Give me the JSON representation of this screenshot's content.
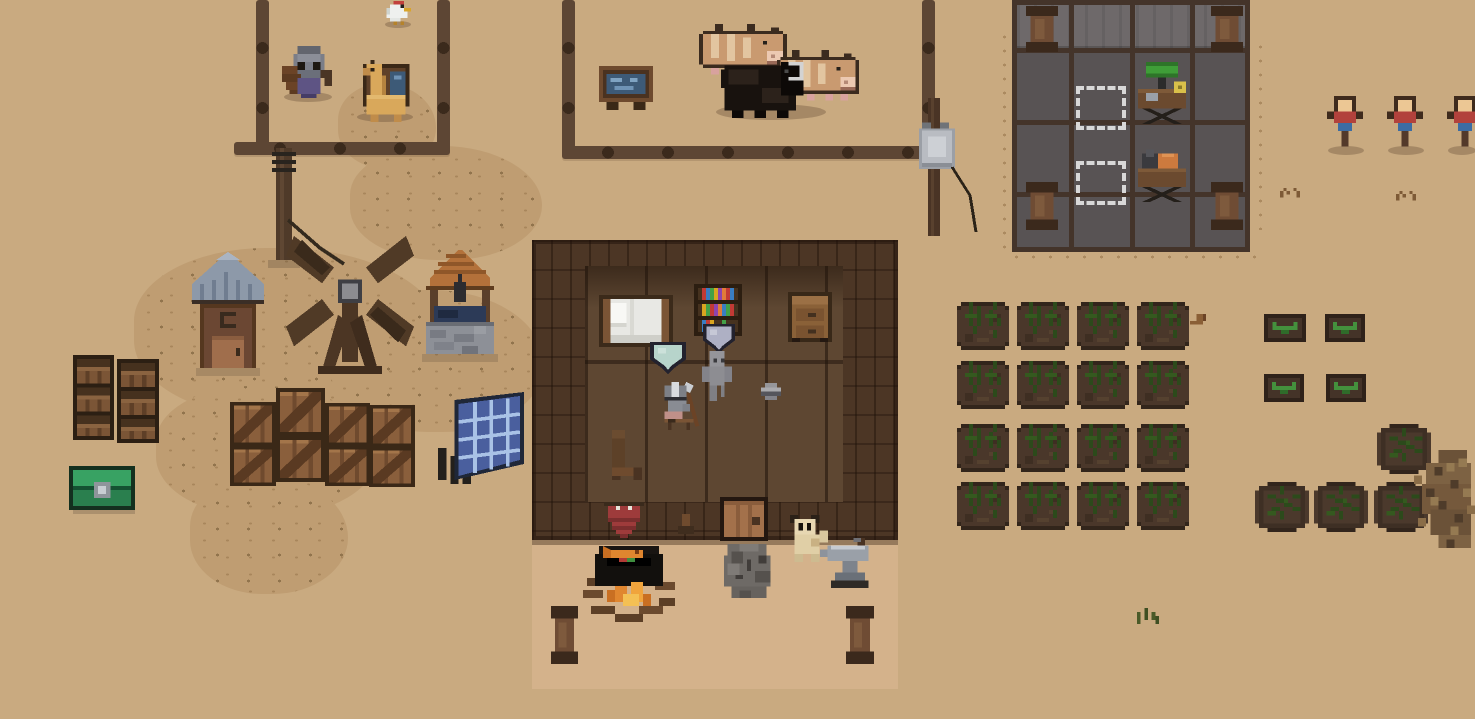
{
  "scene": {
    "width": 1475,
    "height": 719,
    "background": "#c9aa80",
    "title": "Pixel-art desert farm settlement with house, animal pen, workshop and crop field"
  },
  "palette": {
    "sand": "#c9aa80",
    "dirt": "#bf9d72",
    "fence_wood": "#5d4634",
    "fence_knob": "#3b2a1c",
    "house_wall": "#4c3625",
    "house_floor": "#5e4732",
    "porch": "#d4b28b",
    "workshop_floor": "#585354",
    "workshop_wall": "#6e696a",
    "workshop_grid": "#44342a",
    "screen_blue": "#3d5a77",
    "lamp_green": "#3f9e38",
    "machine_orange": "#cd7a3e",
    "banner_red": "#9e3b3b",
    "chest_green": "#2a7f4e",
    "well_water": "#2c3a57",
    "crop_green": "#2c4a1b",
    "sprout_green": "#44913d",
    "dummy_shirt": "#b2423c",
    "dummy_pants": "#3c6ca3"
  },
  "entities": [
    {
      "name": "dirt-path-north",
      "kind": "dirt",
      "x": 338,
      "y": 84,
      "w": 98,
      "h": 84,
      "i": false
    },
    {
      "name": "dirt-path-mid",
      "kind": "dirt",
      "x": 350,
      "y": 146,
      "w": 192,
      "h": 114,
      "i": false
    },
    {
      "name": "dirt-field-west",
      "kind": "dirt",
      "x": 134,
      "y": 248,
      "w": 310,
      "h": 170,
      "i": false
    },
    {
      "name": "dirt-field-center",
      "kind": "dirt",
      "x": 330,
      "y": 290,
      "w": 214,
      "h": 142,
      "i": false
    },
    {
      "name": "dirt-field-southwest",
      "kind": "dirt",
      "x": 156,
      "y": 386,
      "w": 222,
      "h": 130,
      "i": false
    },
    {
      "name": "dirt-patch-south",
      "kind": "dirt",
      "x": 190,
      "y": 476,
      "w": 158,
      "h": 118,
      "i": false
    },
    {
      "name": "speckles-west-of-workshop",
      "kind": "speckles",
      "x": 996,
      "y": 30,
      "w": 22,
      "h": 225,
      "i": false
    },
    {
      "name": "speckles-south-of-workshop",
      "kind": "speckles",
      "x": 1008,
      "y": 250,
      "w": 256,
      "h": 18,
      "i": false
    },
    {
      "name": "speckles-east-of-workshop",
      "kind": "speckles",
      "x": 1252,
      "y": 40,
      "w": 18,
      "h": 190,
      "i": false
    },
    {
      "name": "fence-rail-west-pen-left",
      "kind": "fence-v",
      "x": 256,
      "y": 0,
      "w": 13,
      "h": 152,
      "i": false
    },
    {
      "name": "fence-rail-west-pen-right",
      "kind": "fence-v",
      "x": 437,
      "y": 0,
      "w": 13,
      "h": 152,
      "i": false
    },
    {
      "name": "fence-rail-west-pen-bottom",
      "kind": "fence-h",
      "x": 234,
      "y": 142,
      "w": 216,
      "h": 13,
      "i": false
    },
    {
      "name": "fence-rail-animal-pen-left",
      "kind": "fence-v",
      "x": 562,
      "y": 0,
      "w": 13,
      "h": 158,
      "i": false
    },
    {
      "name": "fence-rail-animal-pen-bottom",
      "kind": "fence-h",
      "x": 562,
      "y": 146,
      "w": 382,
      "h": 13,
      "i": false
    },
    {
      "name": "fence-rail-animal-pen-right",
      "kind": "fence-v",
      "x": 922,
      "y": 0,
      "w": 13,
      "h": 150,
      "i": false
    },
    {
      "name": "power-pole",
      "kind": "electric-pole",
      "x": 268,
      "y": 148,
      "w": 80,
      "h": 120,
      "i": false
    },
    {
      "name": "fence-post-transformer",
      "kind": "fence-pole-box",
      "x": 916,
      "y": 98,
      "w": 72,
      "h": 142,
      "i": true
    },
    {
      "name": "house-wall",
      "kind": "wall",
      "x": 532,
      "y": 240,
      "w": 366,
      "h": 300,
      "i": false
    },
    {
      "name": "house-floor",
      "kind": "floor",
      "x": 585,
      "y": 266,
      "w": 258,
      "h": 236,
      "i": false
    },
    {
      "name": "house-floor-shadow",
      "kind": "floor-shadow",
      "x": 585,
      "y": 266,
      "w": 258,
      "h": 42,
      "i": false
    },
    {
      "name": "house-floor-seam",
      "kind": "bar",
      "x": 585,
      "y": 360,
      "w": 258,
      "h": 4,
      "c": "rgba(30,18,9,.5)",
      "i": false
    },
    {
      "name": "house-porch",
      "kind": "porch",
      "x": 532,
      "y": 540,
      "w": 366,
      "h": 144,
      "i": false
    },
    {
      "name": "workshop-floor",
      "kind": "building-floor",
      "x": 1012,
      "y": 0,
      "w": 238,
      "h": 252,
      "i": false
    },
    {
      "name": "workshop-wall-top",
      "kind": "building-wall-top",
      "x": 1017,
      "y": 4,
      "w": 228,
      "h": 42,
      "i": false
    },
    {
      "name": "workshop-grid-vline-1",
      "kind": "bar",
      "x": 1012,
      "y": 0,
      "w": 5,
      "h": 252,
      "c": "#44342a",
      "i": false
    },
    {
      "name": "workshop-grid-vline-2",
      "kind": "bar",
      "x": 1069,
      "y": 0,
      "w": 5,
      "h": 252,
      "c": "#44342a",
      "i": false
    },
    {
      "name": "workshop-grid-vline-3",
      "kind": "bar",
      "x": 1130,
      "y": 0,
      "w": 5,
      "h": 252,
      "c": "#44342a",
      "i": false
    },
    {
      "name": "workshop-grid-vline-4",
      "kind": "bar",
      "x": 1190,
      "y": 0,
      "w": 5,
      "h": 252,
      "c": "#44342a",
      "i": false
    },
    {
      "name": "workshop-grid-vline-5",
      "kind": "bar",
      "x": 1245,
      "y": 0,
      "w": 5,
      "h": 252,
      "c": "#44342a",
      "i": false
    },
    {
      "name": "workshop-grid-hline-1",
      "kind": "bar",
      "x": 1012,
      "y": 0,
      "w": 238,
      "h": 5,
      "c": "#44342a",
      "i": false
    },
    {
      "name": "workshop-grid-hline-2",
      "kind": "bar",
      "x": 1012,
      "y": 48,
      "w": 238,
      "h": 5,
      "c": "#44342a",
      "i": false
    },
    {
      "name": "workshop-grid-hline-3",
      "kind": "bar",
      "x": 1012,
      "y": 120,
      "w": 238,
      "h": 5,
      "c": "#44342a",
      "i": false
    },
    {
      "name": "workshop-grid-hline-4",
      "kind": "bar",
      "x": 1012,
      "y": 192,
      "w": 238,
      "h": 5,
      "c": "#44342a",
      "i": false
    },
    {
      "name": "workshop-grid-hline-5",
      "kind": "bar",
      "x": 1012,
      "y": 247,
      "w": 238,
      "h": 5,
      "c": "#44342a",
      "i": false
    },
    {
      "name": "workshop-pillar-1",
      "kind": "post",
      "x": 1026,
      "y": 6,
      "w": 32,
      "h": 46,
      "i": false
    },
    {
      "name": "workshop-pillar-2",
      "kind": "post",
      "x": 1211,
      "y": 6,
      "w": 32,
      "h": 46,
      "i": false
    },
    {
      "name": "workshop-pillar-3",
      "kind": "post",
      "x": 1026,
      "y": 182,
      "w": 32,
      "h": 48,
      "i": false
    },
    {
      "name": "workshop-pillar-4",
      "kind": "post",
      "x": 1211,
      "y": 182,
      "w": 32,
      "h": 48,
      "i": false
    },
    {
      "name": "placement-slot-1",
      "kind": "dashed-slot",
      "x": 1076,
      "y": 86,
      "w": 50,
      "h": 44,
      "i": true
    },
    {
      "name": "placement-slot-2",
      "kind": "dashed-slot",
      "x": 1076,
      "y": 161,
      "w": 50,
      "h": 44,
      "i": true
    },
    {
      "name": "workbench-green-lamp",
      "kind": "workbench-green",
      "x": 1130,
      "y": 62,
      "w": 64,
      "h": 62,
      "i": true
    },
    {
      "name": "workbench-orange",
      "kind": "workbench-orange",
      "x": 1130,
      "y": 142,
      "w": 64,
      "h": 60,
      "i": true
    },
    {
      "name": "animal-shadow",
      "kind": "shadow",
      "x": 716,
      "y": 104,
      "w": 110,
      "h": 16,
      "i": false
    },
    {
      "name": "chicken-shadow",
      "kind": "shadow",
      "x": 385,
      "y": 21,
      "w": 26,
      "h": 7,
      "i": false
    },
    {
      "name": "crab-shadow",
      "kind": "shadow",
      "x": 284,
      "y": 92,
      "w": 48,
      "h": 10,
      "i": false
    },
    {
      "name": "llama-shadow",
      "kind": "shadow",
      "x": 357,
      "y": 112,
      "w": 56,
      "h": 10,
      "i": false
    },
    {
      "name": "info-sign",
      "kind": "sign-monitor",
      "x": 599,
      "y": 66,
      "w": 54,
      "h": 44,
      "i": true
    },
    {
      "name": "cow-striped",
      "kind": "cow-tan",
      "x": 699,
      "y": 24,
      "w": 88,
      "h": 54,
      "i": true
    },
    {
      "name": "cow-patched",
      "kind": "cow-tan",
      "x": 777,
      "y": 50,
      "w": 82,
      "h": 54,
      "i": true
    },
    {
      "name": "black-buffalo",
      "kind": "buffalo",
      "x": 717,
      "y": 58,
      "w": 90,
      "h": 60,
      "i": true
    },
    {
      "name": "chicken",
      "kind": "chicken",
      "x": 383,
      "y": 1,
      "w": 28,
      "h": 24,
      "i": true
    },
    {
      "name": "llama-with-crate",
      "kind": "llama-crate",
      "x": 355,
      "y": 60,
      "w": 62,
      "h": 62,
      "i": true
    },
    {
      "name": "hermit-crab",
      "kind": "crab",
      "x": 282,
      "y": 46,
      "w": 50,
      "h": 52,
      "i": true
    },
    {
      "name": "outhouse",
      "kind": "outhouse",
      "x": 188,
      "y": 252,
      "w": 80,
      "h": 128,
      "i": true
    },
    {
      "name": "windmill",
      "kind": "windmill",
      "x": 286,
      "y": 228,
      "w": 128,
      "h": 150,
      "i": true
    },
    {
      "name": "water-well",
      "kind": "well",
      "x": 414,
      "y": 250,
      "w": 92,
      "h": 112,
      "i": true
    },
    {
      "name": "barrel-stack-1",
      "kind": "barrel-stack",
      "x": 73,
      "y": 355,
      "w": 41,
      "h": 85,
      "i": true
    },
    {
      "name": "barrel-stack-2",
      "kind": "barrel-stack",
      "x": 117,
      "y": 359,
      "w": 42,
      "h": 84,
      "i": true
    },
    {
      "name": "green-chest",
      "kind": "chest-green",
      "x": 69,
      "y": 466,
      "w": 66,
      "h": 48,
      "i": true
    },
    {
      "name": "crate-1",
      "kind": "crate",
      "x": 230,
      "y": 402,
      "w": 46,
      "h": 44,
      "i": true
    },
    {
      "name": "crate-2",
      "kind": "crate",
      "x": 276,
      "y": 388,
      "w": 49,
      "h": 48,
      "i": true
    },
    {
      "name": "crate-3",
      "kind": "crate",
      "x": 325,
      "y": 403,
      "w": 45,
      "h": 43,
      "i": true
    },
    {
      "name": "crate-4",
      "kind": "crate",
      "x": 369,
      "y": 405,
      "w": 46,
      "h": 42,
      "i": true
    },
    {
      "name": "crate-5",
      "kind": "crate",
      "x": 230,
      "y": 446,
      "w": 46,
      "h": 40,
      "i": true
    },
    {
      "name": "crate-6",
      "kind": "crate",
      "x": 276,
      "y": 436,
      "w": 49,
      "h": 46,
      "i": true
    },
    {
      "name": "crate-7",
      "kind": "crate",
      "x": 325,
      "y": 446,
      "w": 45,
      "h": 40,
      "i": true
    },
    {
      "name": "crate-8",
      "kind": "crate",
      "x": 369,
      "y": 447,
      "w": 46,
      "h": 40,
      "i": true
    },
    {
      "name": "solar-panel",
      "kind": "solar-panel",
      "x": 434,
      "y": 392,
      "w": 90,
      "h": 92,
      "i": true
    },
    {
      "name": "bed",
      "kind": "bed",
      "x": 599,
      "y": 295,
      "w": 74,
      "h": 52,
      "i": true
    },
    {
      "name": "bookshelf",
      "kind": "bookshelf",
      "x": 694,
      "y": 284,
      "w": 48,
      "h": 52,
      "i": true
    },
    {
      "name": "shield-display-purple",
      "kind": "shield-purple",
      "x": 703,
      "y": 324,
      "w": 32,
      "h": 30,
      "i": true
    },
    {
      "name": "dresser",
      "kind": "dresser",
      "x": 788,
      "y": 292,
      "w": 44,
      "h": 50,
      "i": true
    },
    {
      "name": "shield-display-teal",
      "kind": "shield-teal",
      "x": 650,
      "y": 342,
      "w": 36,
      "h": 32,
      "i": true
    },
    {
      "name": "npc-golem",
      "kind": "golem-npc",
      "x": 702,
      "y": 351,
      "w": 30,
      "h": 50,
      "i": true
    },
    {
      "name": "npc-knight",
      "kind": "knight-npc",
      "x": 657,
      "y": 382,
      "w": 44,
      "h": 48,
      "i": true
    },
    {
      "name": "metal-pot",
      "kind": "pot-item",
      "x": 761,
      "y": 383,
      "w": 20,
      "h": 17,
      "i": true
    },
    {
      "name": "wooden-chair",
      "kind": "chair",
      "x": 608,
      "y": 430,
      "w": 38,
      "h": 50,
      "i": true
    },
    {
      "name": "wall-banner",
      "kind": "banner",
      "x": 604,
      "y": 502,
      "w": 40,
      "h": 40,
      "i": true
    },
    {
      "name": "wall-lever",
      "kind": "lever",
      "x": 678,
      "y": 514,
      "w": 16,
      "h": 20,
      "i": true
    },
    {
      "name": "house-door",
      "kind": "door",
      "x": 720,
      "y": 497,
      "w": 48,
      "h": 44,
      "i": true
    },
    {
      "name": "dog",
      "kind": "dog",
      "x": 786,
      "y": 515,
      "w": 42,
      "h": 47,
      "i": true
    },
    {
      "name": "campfire-cauldron",
      "kind": "cauldron-fire",
      "x": 583,
      "y": 542,
      "w": 96,
      "h": 80,
      "i": true
    },
    {
      "name": "rock-golem",
      "kind": "rock-golem",
      "x": 716,
      "y": 540,
      "w": 62,
      "h": 62,
      "i": true
    },
    {
      "name": "anvil",
      "kind": "anvil",
      "x": 820,
      "y": 538,
      "w": 56,
      "h": 50,
      "i": true
    },
    {
      "name": "porch-post-left",
      "kind": "post",
      "x": 551,
      "y": 606,
      "w": 27,
      "h": 58,
      "i": false
    },
    {
      "name": "porch-post-right",
      "kind": "post",
      "x": 846,
      "y": 606,
      "w": 28,
      "h": 58,
      "i": false
    },
    {
      "name": "crop-plot-r1c1",
      "kind": "crop-plot",
      "x": 957,
      "y": 302,
      "w": 52,
      "h": 48,
      "i": true
    },
    {
      "name": "crop-plot-r1c2",
      "kind": "crop-plot",
      "x": 1017,
      "y": 302,
      "w": 52,
      "h": 48,
      "i": true
    },
    {
      "name": "crop-plot-r1c3",
      "kind": "crop-plot",
      "x": 1077,
      "y": 302,
      "w": 52,
      "h": 48,
      "i": true
    },
    {
      "name": "crop-plot-r1c4",
      "kind": "crop-plot",
      "x": 1137,
      "y": 302,
      "w": 52,
      "h": 48,
      "i": true
    },
    {
      "name": "crop-plot-r2c1",
      "kind": "crop-plot",
      "x": 957,
      "y": 361,
      "w": 52,
      "h": 48,
      "i": true
    },
    {
      "name": "crop-plot-r2c2",
      "kind": "crop-plot",
      "x": 1017,
      "y": 361,
      "w": 52,
      "h": 48,
      "i": true
    },
    {
      "name": "crop-plot-r2c3",
      "kind": "crop-plot",
      "x": 1077,
      "y": 361,
      "w": 52,
      "h": 48,
      "i": true
    },
    {
      "name": "crop-plot-r2c4",
      "kind": "crop-plot",
      "x": 1137,
      "y": 361,
      "w": 52,
      "h": 48,
      "i": true
    },
    {
      "name": "crop-plot-r3c1",
      "kind": "crop-plot",
      "x": 957,
      "y": 424,
      "w": 52,
      "h": 48,
      "i": true
    },
    {
      "name": "crop-plot-r3c2",
      "kind": "crop-plot",
      "x": 1017,
      "y": 424,
      "w": 52,
      "h": 48,
      "i": true
    },
    {
      "name": "crop-plot-r3c3",
      "kind": "crop-plot",
      "x": 1077,
      "y": 424,
      "w": 52,
      "h": 48,
      "i": true
    },
    {
      "name": "crop-plot-r3c4",
      "kind": "crop-plot",
      "x": 1137,
      "y": 424,
      "w": 52,
      "h": 48,
      "i": true
    },
    {
      "name": "crop-plot-r4c1",
      "kind": "crop-plot",
      "x": 957,
      "y": 482,
      "w": 52,
      "h": 48,
      "i": true
    },
    {
      "name": "crop-plot-r4c2",
      "kind": "crop-plot",
      "x": 1017,
      "y": 482,
      "w": 52,
      "h": 48,
      "i": true
    },
    {
      "name": "crop-plot-r4c3",
      "kind": "crop-plot",
      "x": 1077,
      "y": 482,
      "w": 52,
      "h": 48,
      "i": true
    },
    {
      "name": "crop-plot-r4c4",
      "kind": "crop-plot",
      "x": 1137,
      "y": 482,
      "w": 52,
      "h": 48,
      "i": true
    },
    {
      "name": "hoe-tool",
      "kind": "hoe-item",
      "x": 1190,
      "y": 314,
      "w": 16,
      "h": 14,
      "i": true
    },
    {
      "name": "planter-box-1",
      "kind": "planter-box",
      "x": 1264,
      "y": 314,
      "w": 42,
      "h": 28,
      "i": true
    },
    {
      "name": "planter-box-2",
      "kind": "planter-box",
      "x": 1325,
      "y": 314,
      "w": 40,
      "h": 28,
      "i": true
    },
    {
      "name": "planter-box-3",
      "kind": "planter-box",
      "x": 1264,
      "y": 374,
      "w": 40,
      "h": 28,
      "i": true
    },
    {
      "name": "planter-box-4",
      "kind": "planter-box",
      "x": 1326,
      "y": 374,
      "w": 40,
      "h": 28,
      "i": true
    },
    {
      "name": "round-planter-1",
      "kind": "planter-round",
      "x": 1377,
      "y": 424,
      "w": 54,
      "h": 50,
      "i": true
    },
    {
      "name": "round-planter-2",
      "kind": "planter-round",
      "x": 1255,
      "y": 482,
      "w": 54,
      "h": 50,
      "i": true
    },
    {
      "name": "round-planter-3",
      "kind": "planter-round",
      "x": 1314,
      "y": 482,
      "w": 54,
      "h": 50,
      "i": true
    },
    {
      "name": "round-planter-4",
      "kind": "planter-round",
      "x": 1374,
      "y": 482,
      "w": 54,
      "h": 50,
      "i": true
    },
    {
      "name": "dirt-pile",
      "kind": "dirt-pile",
      "x": 1414,
      "y": 450,
      "w": 61,
      "h": 102,
      "i": false
    },
    {
      "name": "dummy-shadow-1",
      "kind": "shadow",
      "x": 1328,
      "y": 146,
      "w": 36,
      "h": 9,
      "i": false
    },
    {
      "name": "dummy-shadow-2",
      "kind": "shadow",
      "x": 1388,
      "y": 146,
      "w": 36,
      "h": 9,
      "i": false
    },
    {
      "name": "dummy-shadow-3",
      "kind": "shadow",
      "x": 1448,
      "y": 146,
      "w": 28,
      "h": 9,
      "i": false
    },
    {
      "name": "training-dummy-1",
      "kind": "dummy",
      "x": 1327,
      "y": 96,
      "w": 36,
      "h": 58,
      "i": true
    },
    {
      "name": "training-dummy-2",
      "kind": "dummy",
      "x": 1387,
      "y": 96,
      "w": 36,
      "h": 58,
      "i": true
    },
    {
      "name": "training-dummy-3",
      "kind": "dummy",
      "x": 1447,
      "y": 96,
      "w": 36,
      "h": 58,
      "i": true
    },
    {
      "name": "twigs-1",
      "kind": "twigs",
      "x": 1280,
      "y": 188,
      "w": 20,
      "h": 16,
      "i": false
    },
    {
      "name": "twigs-2",
      "kind": "twigs",
      "x": 1396,
      "y": 191,
      "w": 20,
      "h": 16,
      "i": false
    },
    {
      "name": "grass-tuft",
      "kind": "grass-tuft",
      "x": 1137,
      "y": 608,
      "w": 22,
      "h": 16,
      "i": false
    }
  ]
}
